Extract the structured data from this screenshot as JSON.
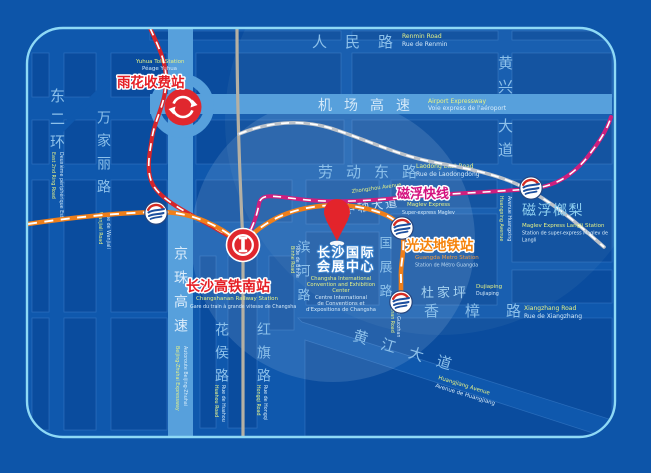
{
  "colors": {
    "background": "#0d55a9",
    "road_gap": "#0f58ad",
    "block": "#0a4c9e",
    "block_border": "#4b8bd4",
    "map_border": "#8ed9f6",
    "highway_band": "#57a0dc",
    "red_route": "#d6252b",
    "metro_orange": "#ef7f1a",
    "maglev_magenta": "#cf1f7e",
    "railway_gray": "#b5b0a3",
    "rail_branch_gray": "#bcc2c9",
    "label_red": "#e51e25",
    "label_orange": "#f5820a",
    "label_magenta": "#d4117e",
    "label_white": "#ffffff",
    "road_label_blue": "#8cc0ea",
    "english_label_yellow": "#e7f386",
    "french_label_white": "#d6ebfa"
  },
  "icons": {
    "toll": "circular-arrows-icon",
    "railway": "china-railway-logo-icon",
    "metro": "changsha-metro-logo-icon",
    "pin": "location-pin-icon"
  },
  "roads": {
    "renmin": {
      "zh": "人民路",
      "en": "Renmin Road",
      "fr": "Rue de Renmin"
    },
    "airport": {
      "zh": "机场高速",
      "en": "Airport Expressway",
      "fr": "Voie express de l'aéroport"
    },
    "laodong": {
      "zh": "劳动东路",
      "en": "Laodong East Road",
      "fr": "Rue de Laodongdong"
    },
    "zhongzhou": {
      "zh": "中轴大道",
      "en": "Zhongzhou Avenue"
    },
    "xiangzhang": {
      "zh": "香樟路",
      "en": "Xiangzhang Road",
      "fr": "Rue de Xiangzhang"
    },
    "huangjiang": {
      "zh": "黄江大道",
      "en": "Huangjiang Avenue",
      "fr": "Avenue de Huangjiang"
    },
    "dongerhuan": {
      "zh": "东二环",
      "en": "East 2nd Ring Road",
      "fr": "Deuxième périphérique Est"
    },
    "wanjiali": {
      "zh": "万家丽路",
      "en": "Wanjiali Road",
      "fr": "Rue de Wanjiali"
    },
    "jingzhu": {
      "zh": "京珠高速",
      "en": "Beijing-Zhuhai Expressway",
      "fr": "Autoroute Beijing-Zhuhai"
    },
    "huahou": {
      "zh": "花侯路",
      "en": "Huahou Road",
      "fr": "Rue de Huahou"
    },
    "hongqi": {
      "zh": "红旗路",
      "en": "Hongqi Road",
      "fr": "Rue de Hongqi"
    },
    "binhe": {
      "zh": "滨河路",
      "en": "Binhe Road",
      "fr": "Rue de Binhe"
    },
    "guozhan": {
      "zh": "国展路",
      "en": "Guozhan Road",
      "fr": "Rue de Guozhan"
    },
    "huangxing": {
      "zh_lines": [
        "黄兴",
        "大道"
      ],
      "en": "Huangxing Avenue",
      "fr": "Avenue Huangxing"
    }
  },
  "stations": {
    "yuhua_toll": {
      "zh": "雨花收费站",
      "en": "Yuhua Toll Station",
      "fr": "Péage Yuhua"
    },
    "railway_south": {
      "zh": "长沙高铁南站",
      "en": "Changshanan Railway Station",
      "fr": "Gare du train à grande vitesse de Changsha"
    },
    "convention_center": {
      "zh_lines": [
        "长沙国际",
        "会展中心"
      ],
      "en_lines": [
        "Changsha International",
        "Convention and Exhibition",
        "Center"
      ],
      "fr_lines": [
        "Centre International",
        "de Conventions et",
        "d'Expositions de Changsha"
      ]
    },
    "maglev_express": {
      "zh": "磁浮快线",
      "en": "Maglev Express",
      "fr": "Super-express Maglev"
    },
    "guangda": {
      "zh": "光达地铁站",
      "en": "Guangda Metro Station",
      "fr": "Station de Métro Guangda"
    },
    "dujiaping": {
      "zh": "杜家坪",
      "en": "Dujiaping",
      "fr": "Dujiaping"
    },
    "langli": {
      "zh": "磁浮榔梨",
      "en": "Maglev Express Langli Station",
      "fr_lines": [
        "Station de super-express Maglev de",
        "Langli"
      ]
    }
  }
}
